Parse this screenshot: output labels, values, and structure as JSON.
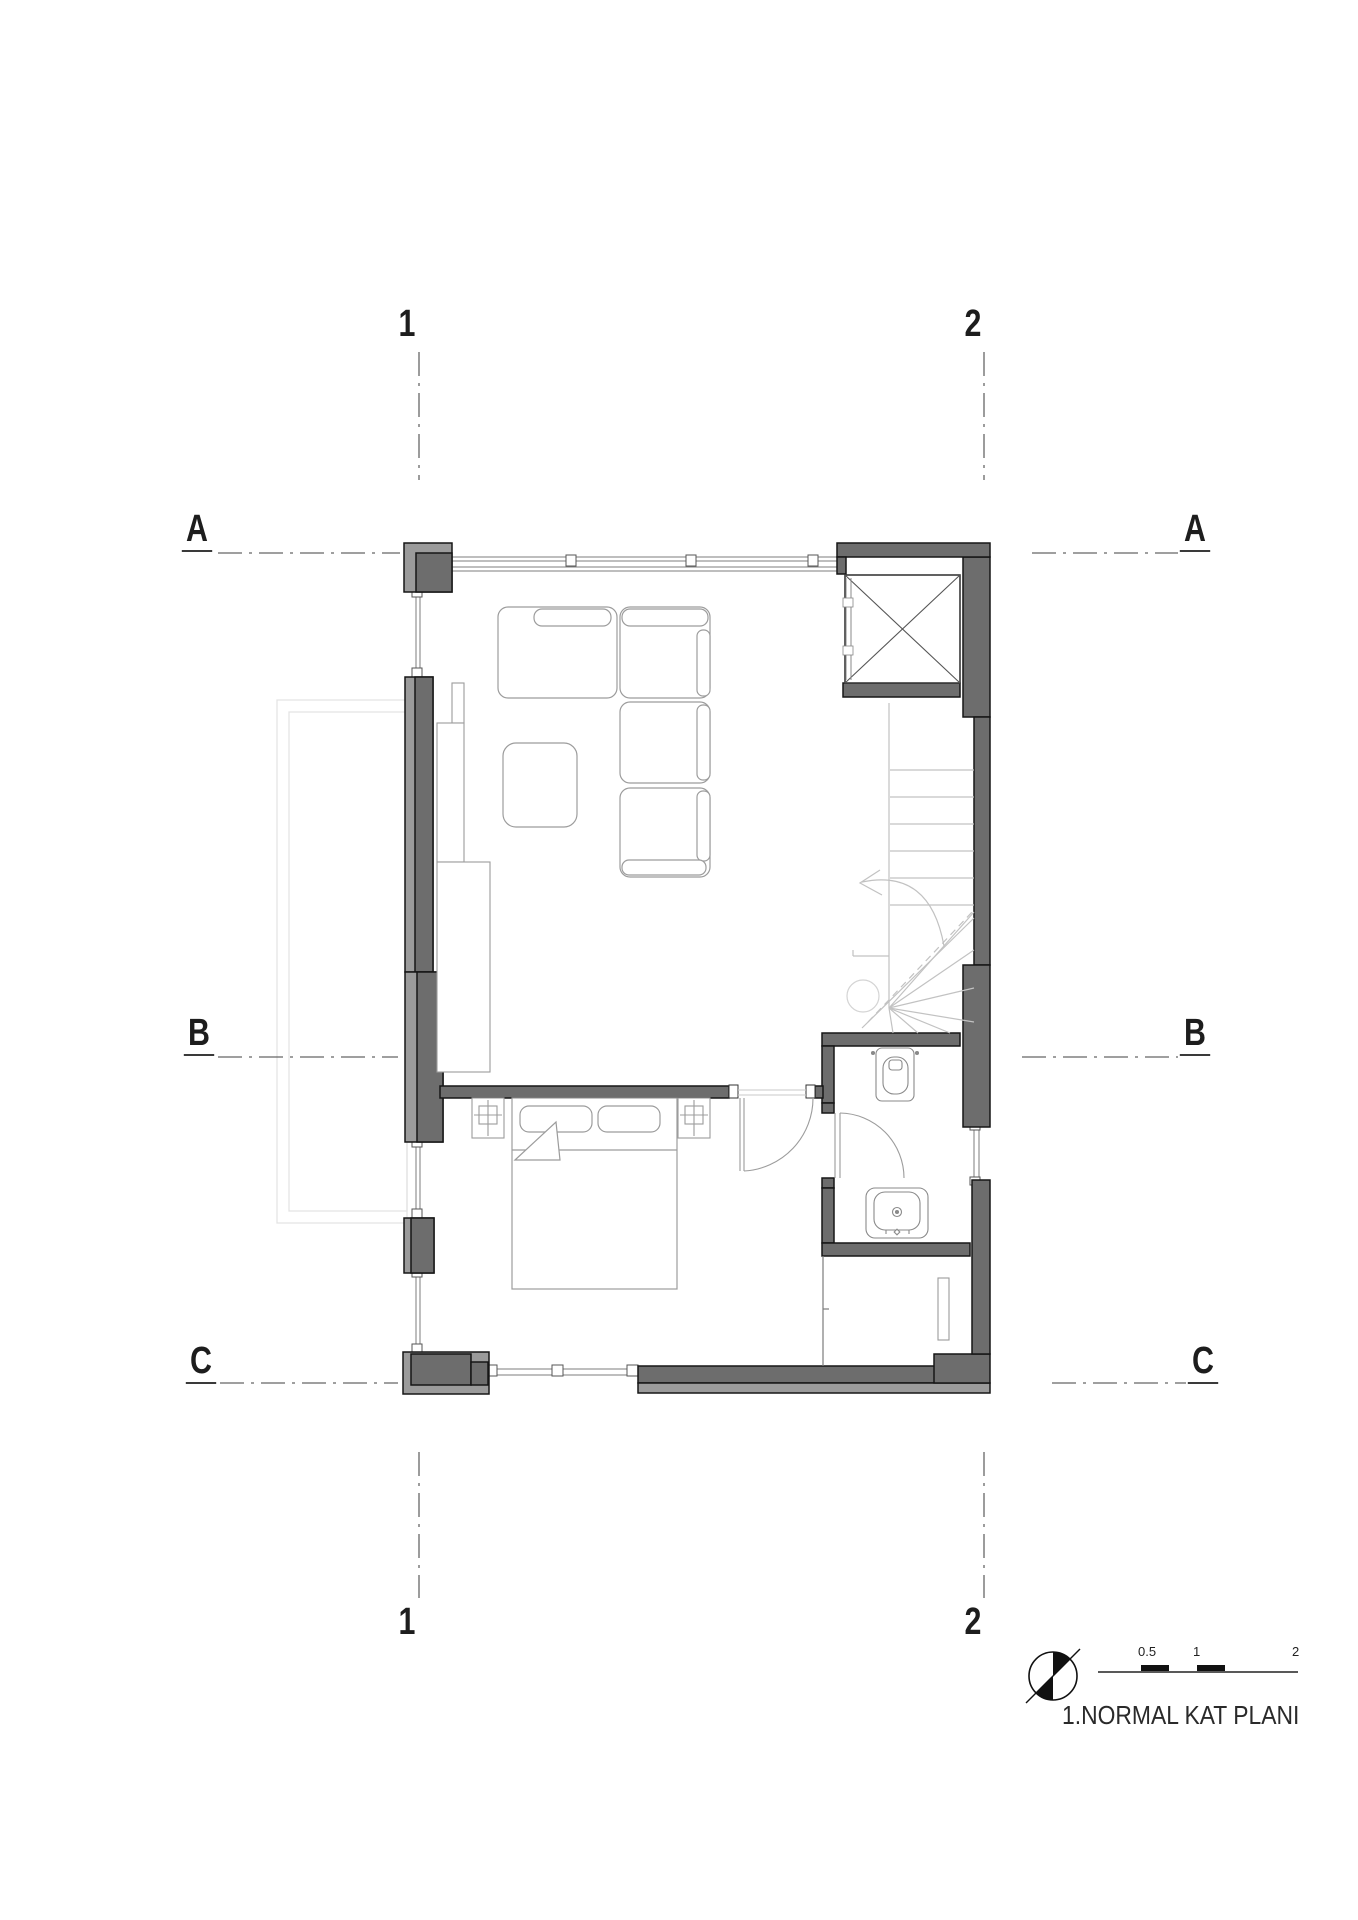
{
  "drawing": {
    "title": "1.NORMAL KAT PLANI",
    "grid": {
      "col1": "1",
      "col2": "2",
      "rowA": "A",
      "rowB": "B",
      "rowC": "C"
    },
    "scale": {
      "l05": "0.5",
      "l1": "1",
      "l2": "2"
    },
    "icons": {
      "north": "north-compass-icon"
    },
    "colors": {
      "wall_dark": "#6d6d6d",
      "wall_light": "#9b9b9b",
      "wall_outline": "#161616",
      "furniture_line": "#999999",
      "stair_line": "#c2c2c2",
      "faint_projection": "#e4e4e4",
      "axis_line": "#666666"
    }
  }
}
